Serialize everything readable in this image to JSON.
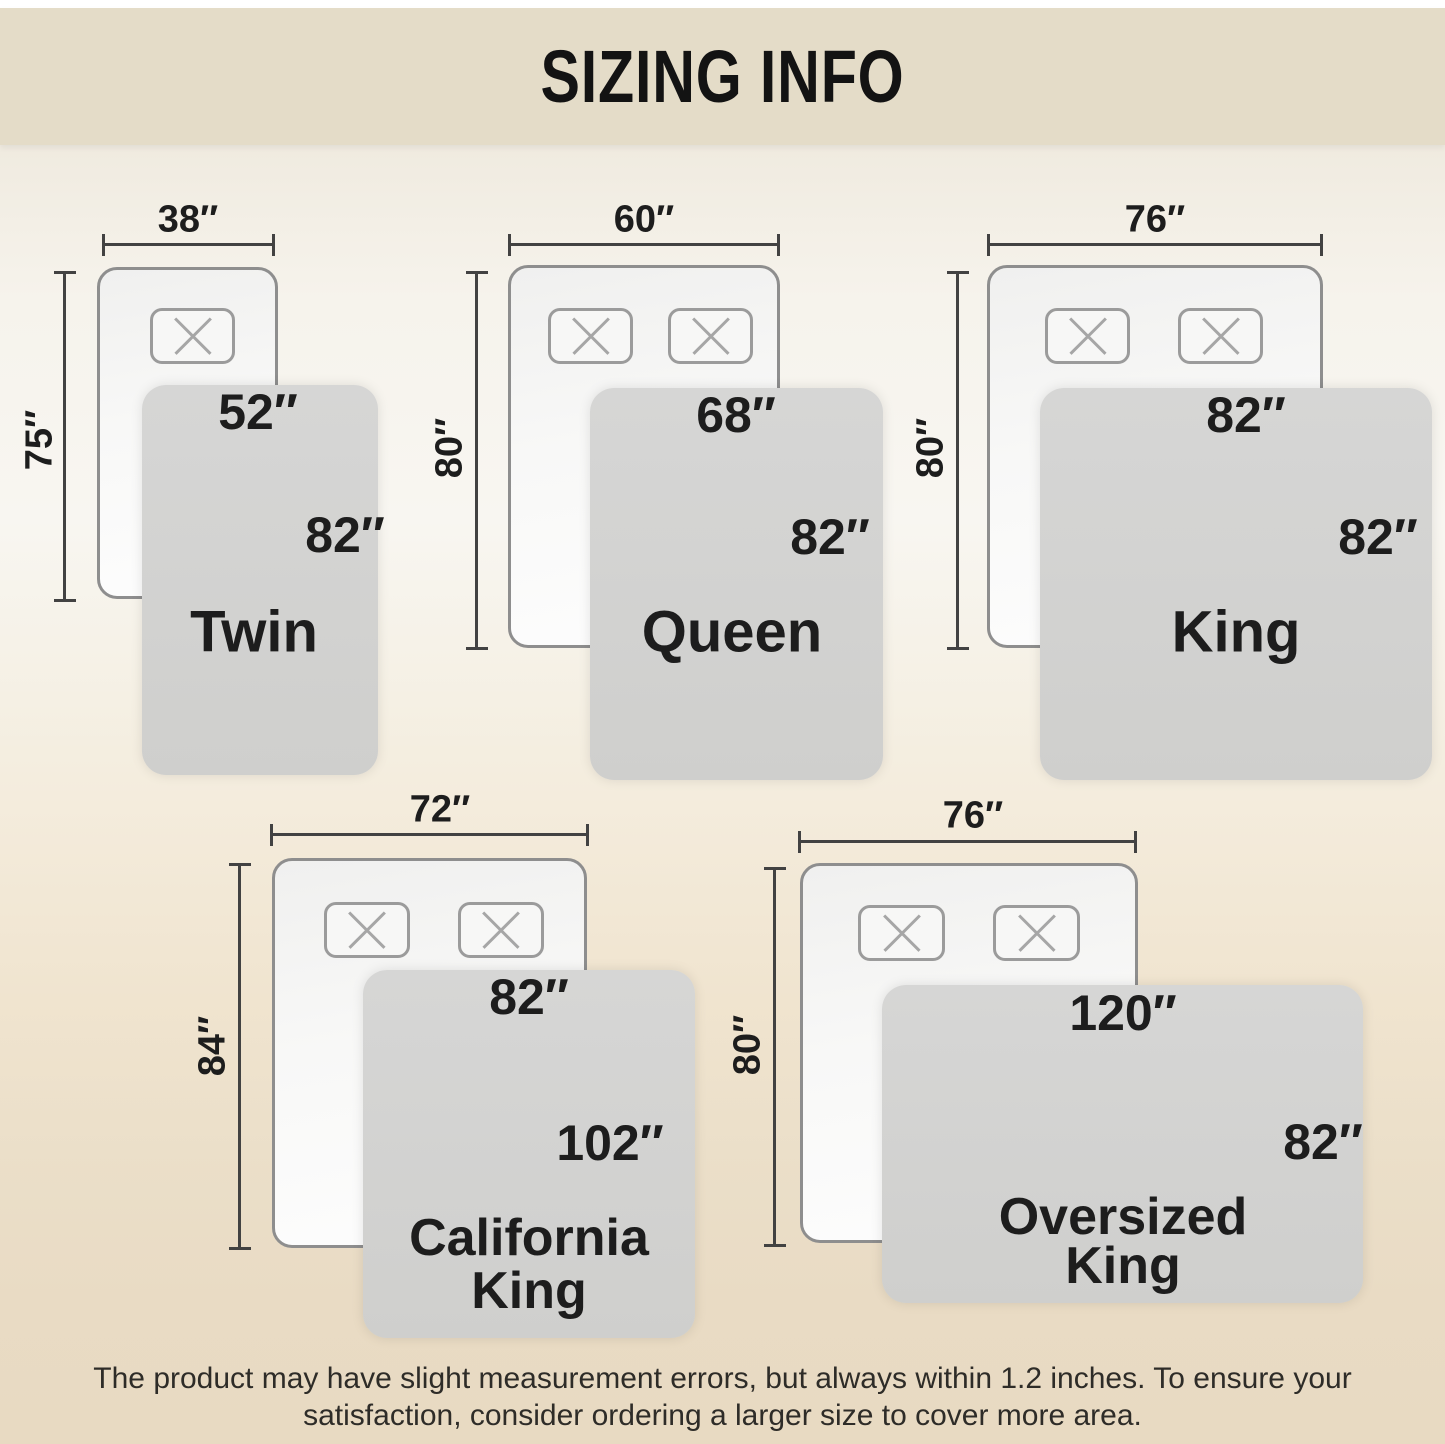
{
  "title": "SIZING INFO",
  "disclaimer": {
    "line1": "The product may have slight measurement errors, but always within 1.2 inches. To ensure your",
    "line2": "satisfaction, consider ordering a larger size to cover more area."
  },
  "sizes": [
    {
      "name": "Twin",
      "bed_width": "38″",
      "bed_length": "75″",
      "blanket_width": "52″",
      "blanket_length": "82″"
    },
    {
      "name": "Queen",
      "bed_width": "60″",
      "bed_length": "80″",
      "blanket_width": "68″",
      "blanket_length": "82″"
    },
    {
      "name": "King",
      "bed_width": "76″",
      "bed_length": "80″",
      "blanket_width": "82″",
      "blanket_length": "82″"
    },
    {
      "name_line1": "California",
      "name_line2": "King",
      "bed_width": "72″",
      "bed_length": "84″",
      "blanket_width": "82″",
      "blanket_length": "102″"
    },
    {
      "name_line1": "Oversized",
      "name_line2": "King",
      "bed_width": "76″",
      "bed_length": "80″",
      "blanket_width": "120″",
      "blanket_length": "82″"
    }
  ],
  "colors": {
    "banner_bg": "#e4dcc8",
    "page_bottom_bg": "#e8dac2",
    "blanket_fill": "#d2d2d1",
    "bed_border": "#8e8e8e",
    "dimension_line": "#424242",
    "text": "#1d1d1d"
  }
}
